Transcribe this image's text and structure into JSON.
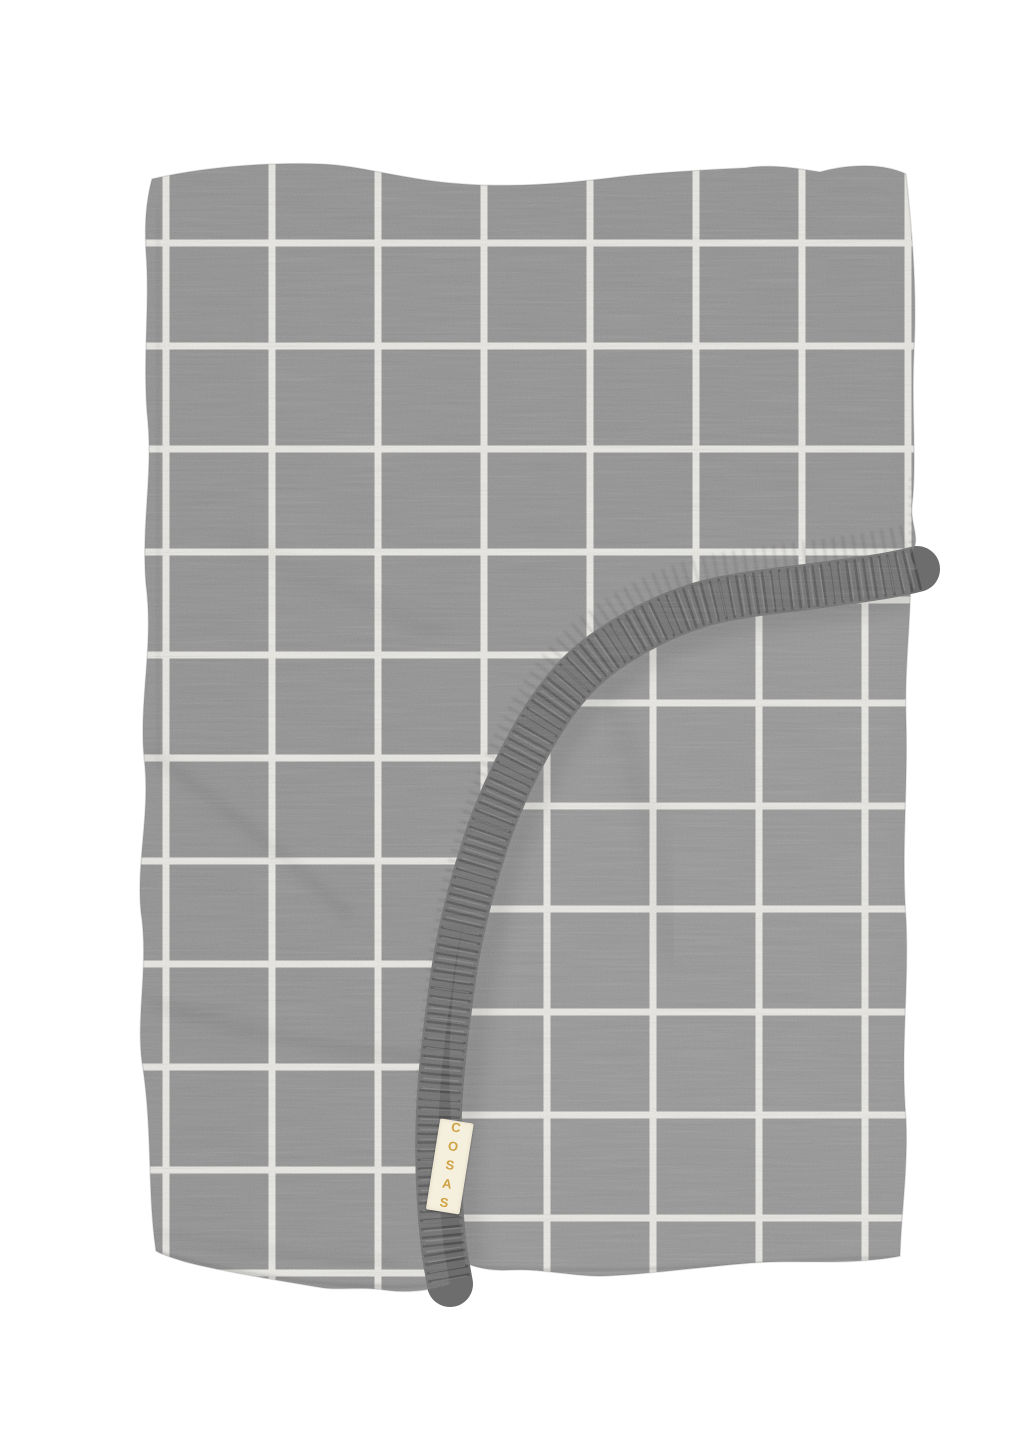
{
  "photo": {
    "background_color": "#ffffff",
    "brand_tag": {
      "text": "COSAS"
    },
    "colors": {
      "fabric_top": "#909090",
      "fabric_under": "#959595",
      "grid_line": "#ecebe6",
      "elastic_band": "#6d6d6d",
      "elastic_stitch": "#383838",
      "elastic_highlight": "#b5b5b5",
      "tag_background": "#f5efdd",
      "tag_text": "#cfa243"
    }
  }
}
